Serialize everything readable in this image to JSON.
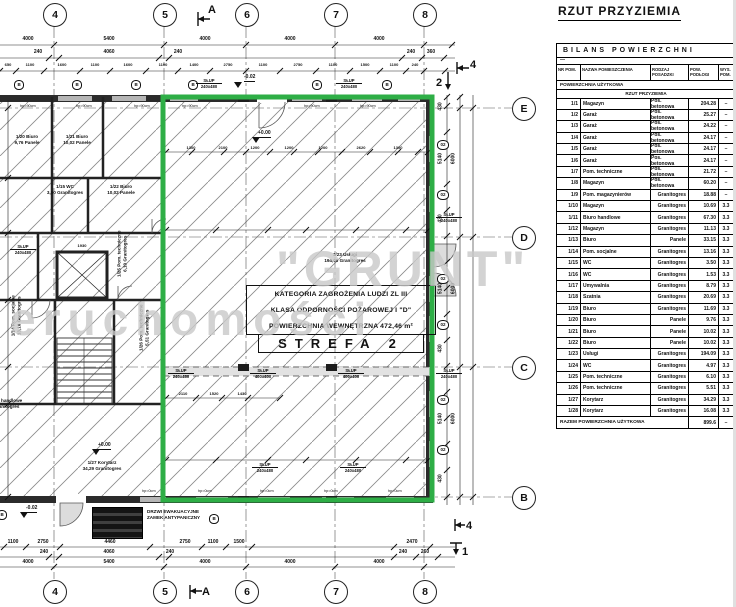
{
  "page_title": "RZUT PRZYZIEMIA",
  "table": {
    "title": "BILANS POWIERZCHNI",
    "dash": "—",
    "columns": {
      "nr": "NR POM.",
      "name": "NAZWA POMIESZCZENIA",
      "floor": "RODZAJ POSADZKI",
      "area": "POW. PODŁOGI",
      "height": "WYS. POM."
    },
    "section": "POWIERZCHNIA UŻYTKOWA",
    "subsection": "RZUT PRZYZIEMIA",
    "rows": [
      {
        "nr": "1/1",
        "name": "Magazyn",
        "floor": "Pos. betonowa",
        "area": "204.28",
        "h": "–"
      },
      {
        "nr": "1/2",
        "name": "Garaż",
        "floor": "Pos. betonowa",
        "area": "25.27",
        "h": "–"
      },
      {
        "nr": "1/3",
        "name": "Garaż",
        "floor": "Pos. betonowa",
        "area": "24.22",
        "h": "–"
      },
      {
        "nr": "1/4",
        "name": "Garaż",
        "floor": "Pos. betonowa",
        "area": "24.17",
        "h": "–"
      },
      {
        "nr": "1/5",
        "name": "Garaż",
        "floor": "Pos. betonowa",
        "area": "24.17",
        "h": "–"
      },
      {
        "nr": "1/6",
        "name": "Garaż",
        "floor": "Pos. betonowa",
        "area": "24.17",
        "h": "–"
      },
      {
        "nr": "1/7",
        "name": "Pom. techniczne",
        "floor": "Pos. betonowa",
        "area": "21.72",
        "h": "–"
      },
      {
        "nr": "1/8",
        "name": "Magazyn",
        "floor": "Pos. betonowa",
        "area": "60.20",
        "h": "–"
      },
      {
        "nr": "1/9",
        "name": "Pom. magazynierów",
        "floor": "Granitogres",
        "area": "18.88",
        "h": "–"
      },
      {
        "nr": "1/10",
        "name": "Magazyn",
        "floor": "Granitogres",
        "area": "10.69",
        "h": "3.3"
      },
      {
        "nr": "1/11",
        "name": "Biuro handlowe",
        "floor": "Granitogres",
        "area": "67.30",
        "h": "3.3"
      },
      {
        "nr": "1/12",
        "name": "Magazyn",
        "floor": "Granitogres",
        "area": "11.13",
        "h": "3.3"
      },
      {
        "nr": "1/13",
        "name": "Biuro",
        "floor": "Panele",
        "area": "33.15",
        "h": "3.3"
      },
      {
        "nr": "1/14",
        "name": "Pom. socjalne",
        "floor": "Granitogres",
        "area": "13.16",
        "h": "3.3"
      },
      {
        "nr": "1/15",
        "name": "WC",
        "floor": "Granitogres",
        "area": "3.50",
        "h": "3.3"
      },
      {
        "nr": "1/16",
        "name": "WC",
        "floor": "Granitogres",
        "area": "1.53",
        "h": "3.3"
      },
      {
        "nr": "1/17",
        "name": "Umywalnia",
        "floor": "Granitogres",
        "area": "8.79",
        "h": "3.3"
      },
      {
        "nr": "1/18",
        "name": "Szatnia",
        "floor": "Granitogres",
        "area": "20.69",
        "h": "3.3"
      },
      {
        "nr": "1/19",
        "name": "Biuro",
        "floor": "Granitogres",
        "area": "11.69",
        "h": "3.3"
      },
      {
        "nr": "1/20",
        "name": "Biuro",
        "floor": "Panele",
        "area": "9.76",
        "h": "3.3"
      },
      {
        "nr": "1/21",
        "name": "Biuro",
        "floor": "Panele",
        "area": "10.02",
        "h": "3.3"
      },
      {
        "nr": "1/22",
        "name": "Biuro",
        "floor": "Panele",
        "area": "10.02",
        "h": "3.3"
      },
      {
        "nr": "1/23",
        "name": "Usługi",
        "floor": "Granitogres",
        "area": "194.09",
        "h": "3.3"
      },
      {
        "nr": "1/24",
        "name": "WC",
        "floor": "Granitogres",
        "area": "4.97",
        "h": "3.3"
      },
      {
        "nr": "1/25",
        "name": "Pom. techniczne",
        "floor": "Granitogres",
        "area": "6.10",
        "h": "3.3"
      },
      {
        "nr": "1/26",
        "name": "Pom. techniczne",
        "floor": "Granitogres",
        "area": "5.51",
        "h": "3.3"
      },
      {
        "nr": "1/27",
        "name": "Korytarz",
        "floor": "Granitogres",
        "area": "34.29",
        "h": "3.3"
      },
      {
        "nr": "1/28",
        "name": "Korytarz",
        "floor": "Granitogres",
        "area": "16.08",
        "h": "3.3"
      }
    ],
    "total_label": "RAZEM POWIERZCHNIA UŻYTKOWA",
    "total_area": "899.6",
    "total_h": "–"
  },
  "plan": {
    "accent_green": "#2EAE46",
    "watermark1": "\"GRUNT\"",
    "watermark2": "Nieruchomości",
    "fire": {
      "l1": "KATEGORIA ZAGROŻENIA LUDZI ZL III",
      "l2": "KLASA ODPORNOŚCI POŻAROWEJ I \"D\"",
      "l3": "POWIERZCHNIA WEWNĘTRZNA 472,46 m²",
      "zone": "STREFA 2"
    },
    "door_note": {
      "l1": "DRZWI EWAKUACYJNE",
      "l2": "ZAMEK ANTYPANICZNY"
    },
    "bubbles": [
      {
        "t": "4",
        "s": "left:43px;top:3px"
      },
      {
        "t": "5",
        "s": "left:153px;top:3px"
      },
      {
        "t": "6",
        "s": "left:235px;top:3px"
      },
      {
        "t": "7",
        "s": "left:324px;top:3px"
      },
      {
        "t": "8",
        "s": "left:413px;top:3px"
      },
      {
        "t": "4",
        "s": "left:43px;top:580px"
      },
      {
        "t": "5",
        "s": "left:153px;top:580px"
      },
      {
        "t": "6",
        "s": "left:235px;top:580px"
      },
      {
        "t": "7",
        "s": "left:324px;top:580px"
      },
      {
        "t": "8",
        "s": "left:413px;top:580px"
      },
      {
        "t": "E",
        "s": "left:512px;top:97px"
      },
      {
        "t": "D",
        "s": "left:512px;top:226px"
      },
      {
        "t": "C",
        "s": "left:512px;top:356px"
      },
      {
        "t": "B",
        "s": "left:512px;top:486px"
      }
    ],
    "tags_b": [
      {
        "t": "B",
        "s": "left:14px;top:80px"
      },
      {
        "t": "B",
        "s": "left:72px;top:80px"
      },
      {
        "t": "B",
        "s": "left:131px;top:80px"
      },
      {
        "t": "B",
        "s": "left:188px;top:80px"
      },
      {
        "t": "B",
        "s": "left:312px;top:80px"
      },
      {
        "t": "B",
        "s": "left:382px;top:80px"
      },
      {
        "t": "B",
        "s": "left:209px;top:514px"
      },
      {
        "t": "B",
        "s": "left:-3px;top:510px"
      }
    ],
    "tags_o2": [
      {
        "t": "02",
        "s": "left:437px;top:140px"
      },
      {
        "t": "02",
        "s": "left:437px;top:190px"
      },
      {
        "t": "02",
        "s": "left:437px;top:274px"
      },
      {
        "t": "02",
        "s": "left:437px;top:320px"
      },
      {
        "t": "02",
        "s": "left:437px;top:395px"
      },
      {
        "t": "02",
        "s": "left:437px;top:445px"
      }
    ],
    "rooms": [
      {
        "l1": "1/20 Biuro",
        "l2": "9,76 Panele",
        "s": "left:6px;top:134px;width:42px"
      },
      {
        "l1": "1/21 Biuro",
        "l2": "10,02 Panele",
        "s": "left:56px;top:134px;width:42px"
      },
      {
        "l1": "1/15 WC",
        "l2": "3,50 Granitogres",
        "s": "left:44px;top:184px;width:42px"
      },
      {
        "l1": "1/22 Biuro",
        "l2": "10,02 Panele",
        "s": "left:98px;top:184px;width:46px"
      },
      {
        "l1": "1/23 Usługi",
        "l2": "194,09 Granitogres",
        "s": "left:316px;top:252px;width:58px"
      },
      {
        "l1": "1/27 Korytarz",
        "l2": "34,29 Granitogres",
        "s": "left:72px;top:460px;width:60px"
      },
      {
        "l1": "1/14 Pom. socjalne",
        "l2": "13,16 Granitogres",
        "s": "left:-14px;top:310px;width:60px;transform:rotate(-90deg)"
      },
      {
        "l1": "1/26 Pom. techniczne",
        "l2": "5,51 Granitogres",
        "s": "left:112px;top:322px;width:64px;transform:rotate(-90deg)"
      },
      {
        "l1": "1/25 Pom. techniczne",
        "l2": "6,10 Granitogres",
        "s": "left:90px;top:248px;width:64px;transform:rotate(-90deg)"
      },
      {
        "l1": "1/11 Biuro handlowe",
        "l2": "67,30 Granitogres",
        "s": "left:-30px;top:398px;width:60px"
      }
    ],
    "slups": [
      {
        "l1": "SŁUP",
        "l2": "240x480",
        "s": "left:196px;top:78px;width:26px"
      },
      {
        "l1": "SŁUP",
        "l2": "240x480",
        "s": "left:336px;top:78px;width:26px"
      },
      {
        "l1": "SŁUP",
        "l2": "240x480",
        "s": "left:436px;top:212px;width:26px"
      },
      {
        "l1": "SŁUP",
        "l2": "240x480",
        "s": "left:436px;top:368px;width:26px"
      },
      {
        "l1": "SŁUP",
        "l2": "240x480",
        "s": "left:10px;top:244px;width:26px"
      },
      {
        "l1": "SŁUP",
        "l2": "240x480",
        "s": "left:168px;top:368px;width:26px"
      },
      {
        "l1": "SŁUP",
        "l2": "400x400",
        "s": "left:250px;top:368px;width:26px"
      },
      {
        "l1": "SŁUP",
        "l2": "400x400",
        "s": "left:338px;top:368px;width:26px"
      },
      {
        "l1": "SŁUP",
        "l2": "240x480",
        "s": "left:252px;top:462px;width:26px"
      },
      {
        "l1": "SŁUP",
        "l2": "240x480",
        "s": "left:340px;top:462px;width:26px"
      }
    ],
    "hps": [
      {
        "t": "hp=90cm",
        "s": "left:20px;top:104px;width:24px"
      },
      {
        "t": "hp=90cm",
        "s": "left:76px;top:104px;width:24px"
      },
      {
        "t": "hp=90cm",
        "s": "left:134px;top:104px;width:24px"
      },
      {
        "t": "hp=90cm",
        "s": "left:182px;top:104px;width:24px"
      },
      {
        "t": "hp=90cm",
        "s": "left:304px;top:104px;width:24px"
      },
      {
        "t": "hp=90cm",
        "s": "left:360px;top:104px;width:24px"
      },
      {
        "t": "hp=0cm",
        "s": "left:142px;top:489px;width:24px"
      },
      {
        "t": "hp=0cm",
        "s": "left:198px;top:489px;width:24px"
      },
      {
        "t": "hp=0cm",
        "s": "left:260px;top:489px;width:24px"
      },
      {
        "t": "hp=0cm",
        "s": "left:324px;top:489px;width:24px"
      },
      {
        "t": "hp=0cm",
        "s": "left:388px;top:489px;width:24px"
      }
    ],
    "levels": [
      {
        "t": "-0.02",
        "s": "left:244px;top:74px"
      },
      {
        "t": "+0.00",
        "s": "left:258px;top:130px"
      },
      {
        "t": "+0.00",
        "s": "left:98px;top:442px"
      },
      {
        "t": "-0.02",
        "s": "left:26px;top:505px"
      }
    ],
    "sections": [
      {
        "t": "A",
        "s": "left:208px;top:4px"
      },
      {
        "t": "A",
        "s": "left:202px;top:586px"
      },
      {
        "t": "2",
        "s": "left:436px;top:77px"
      },
      {
        "t": "4",
        "s": "left:470px;top:59px"
      },
      {
        "t": "4",
        "s": "left:466px;top:520px"
      },
      {
        "t": "1",
        "s": "left:462px;top:546px"
      }
    ],
    "dims": [
      {
        "t": "4000",
        "s": "left:6px;top:37px;width:44px"
      },
      {
        "t": "5400",
        "s": "left:87px;top:37px;width:44px"
      },
      {
        "t": "4000",
        "s": "left:183px;top:37px;width:44px"
      },
      {
        "t": "4000",
        "s": "left:268px;top:37px;width:44px"
      },
      {
        "t": "4000",
        "s": "left:357px;top:37px;width:44px"
      },
      {
        "t": "240",
        "s": "left:28px;top:50px;width:20px"
      },
      {
        "t": "4060",
        "s": "left:87px;top:50px;width:44px"
      },
      {
        "t": "240",
        "s": "left:168px;top:50px;width:20px"
      },
      {
        "t": "240",
        "s": "left:402px;top:50px;width:18px"
      },
      {
        "t": "360",
        "s": "left:422px;top:50px;width:18px"
      },
      {
        "t": "650",
        "s": "left:0px;top:63px;width:16px;font-size:4px"
      },
      {
        "t": "1100",
        "s": "left:16px;top:63px;width:28px;font-size:4px"
      },
      {
        "t": "1600",
        "s": "left:44px;top:63px;width:36px;font-size:4px"
      },
      {
        "t": "1100",
        "s": "left:80px;top:63px;width:30px;font-size:4px"
      },
      {
        "t": "1600",
        "s": "left:110px;top:63px;width:36px;font-size:4px"
      },
      {
        "t": "1100",
        "s": "left:146px;top:63px;width:34px;font-size:4px"
      },
      {
        "t": "1400",
        "s": "left:178px;top:63px;width:32px;font-size:4px"
      },
      {
        "t": "2750",
        "s": "left:210px;top:63px;width:36px;font-size:4px"
      },
      {
        "t": "1100",
        "s": "left:246px;top:63px;width:34px;font-size:4px"
      },
      {
        "t": "2750",
        "s": "left:280px;top:63px;width:36px;font-size:4px"
      },
      {
        "t": "1100",
        "s": "left:316px;top:63px;width:34px;font-size:4px"
      },
      {
        "t": "1500",
        "s": "left:350px;top:63px;width:30px;font-size:4px"
      },
      {
        "t": "1100",
        "s": "left:380px;top:63px;width:28px;font-size:4px"
      },
      {
        "t": "240",
        "s": "left:406px;top:63px;width:18px;font-size:4px"
      },
      {
        "t": "1100",
        "s": "left:2px;top:540px;width:22px"
      },
      {
        "t": "2750",
        "s": "left:26px;top:540px;width:34px"
      },
      {
        "t": "4460",
        "s": "left:88px;top:540px;width:44px"
      },
      {
        "t": "2750",
        "s": "left:168px;top:540px;width:34px"
      },
      {
        "t": "1100",
        "s": "left:200px;top:540px;width:26px"
      },
      {
        "t": "1500",
        "s": "left:226px;top:540px;width:26px"
      },
      {
        "t": "2470",
        "s": "left:394px;top:540px;width:36px"
      },
      {
        "t": "240",
        "s": "left:34px;top:550px;width:20px"
      },
      {
        "t": "4060",
        "s": "left:87px;top:550px;width:44px"
      },
      {
        "t": "240",
        "s": "left:160px;top:550px;width:20px"
      },
      {
        "t": "240",
        "s": "left:394px;top:550px;width:18px"
      },
      {
        "t": "260",
        "s": "left:416px;top:550px;width:18px"
      },
      {
        "t": "4000",
        "s": "left:6px;top:560px;width:44px"
      },
      {
        "t": "5400",
        "s": "left:87px;top:560px;width:44px"
      },
      {
        "t": "4000",
        "s": "left:183px;top:560px;width:44px"
      },
      {
        "t": "4000",
        "s": "left:268px;top:560px;width:44px"
      },
      {
        "t": "4000",
        "s": "left:357px;top:560px;width:44px"
      },
      {
        "t": "430",
        "s": "left:426px;top:104px;width:30px;transform:rotate(-90deg)"
      },
      {
        "t": "5140",
        "s": "left:426px;top:156px;width:30px;transform:rotate(-90deg)"
      },
      {
        "t": "430",
        "s": "left:426px;top:216px;width:30px;transform:rotate(-90deg)"
      },
      {
        "t": "5140",
        "s": "left:426px;top:286px;width:30px;transform:rotate(-90deg)"
      },
      {
        "t": "430",
        "s": "left:426px;top:346px;width:30px;transform:rotate(-90deg)"
      },
      {
        "t": "5140",
        "s": "left:426px;top:416px;width:30px;transform:rotate(-90deg)"
      },
      {
        "t": "430",
        "s": "left:426px;top:476px;width:30px;transform:rotate(-90deg)"
      },
      {
        "t": "6000",
        "s": "left:439px;top:156px;width:30px;transform:rotate(-90deg)"
      },
      {
        "t": "6000",
        "s": "left:439px;top:286px;width:30px;transform:rotate(-90deg)"
      },
      {
        "t": "6000",
        "s": "left:439px;top:416px;width:30px;transform:rotate(-90deg)"
      },
      {
        "t": "1300",
        "s": "left:178px;top:146px;width:26px;font-size:4px"
      },
      {
        "t": "2100",
        "s": "left:208px;top:146px;width:30px;font-size:4px"
      },
      {
        "t": "1200",
        "s": "left:242px;top:146px;width:26px;font-size:4px"
      },
      {
        "t": "1200",
        "s": "left:276px;top:146px;width:26px;font-size:4px"
      },
      {
        "t": "1200",
        "s": "left:310px;top:146px;width:26px;font-size:4px"
      },
      {
        "t": "2620",
        "s": "left:344px;top:146px;width:34px;font-size:4px"
      },
      {
        "t": "1300",
        "s": "left:384px;top:146px;width:28px;font-size:4px"
      },
      {
        "t": "2110",
        "s": "left:168px;top:392px;width:30px;font-size:4px"
      },
      {
        "t": "1520",
        "s": "left:200px;top:392px;width:28px;font-size:4px"
      },
      {
        "t": "1430",
        "s": "left:228px;top:392px;width:28px;font-size:4px"
      },
      {
        "t": "1930",
        "s": "left:64px;top:244px;width:36px;font-size:4px"
      }
    ]
  }
}
